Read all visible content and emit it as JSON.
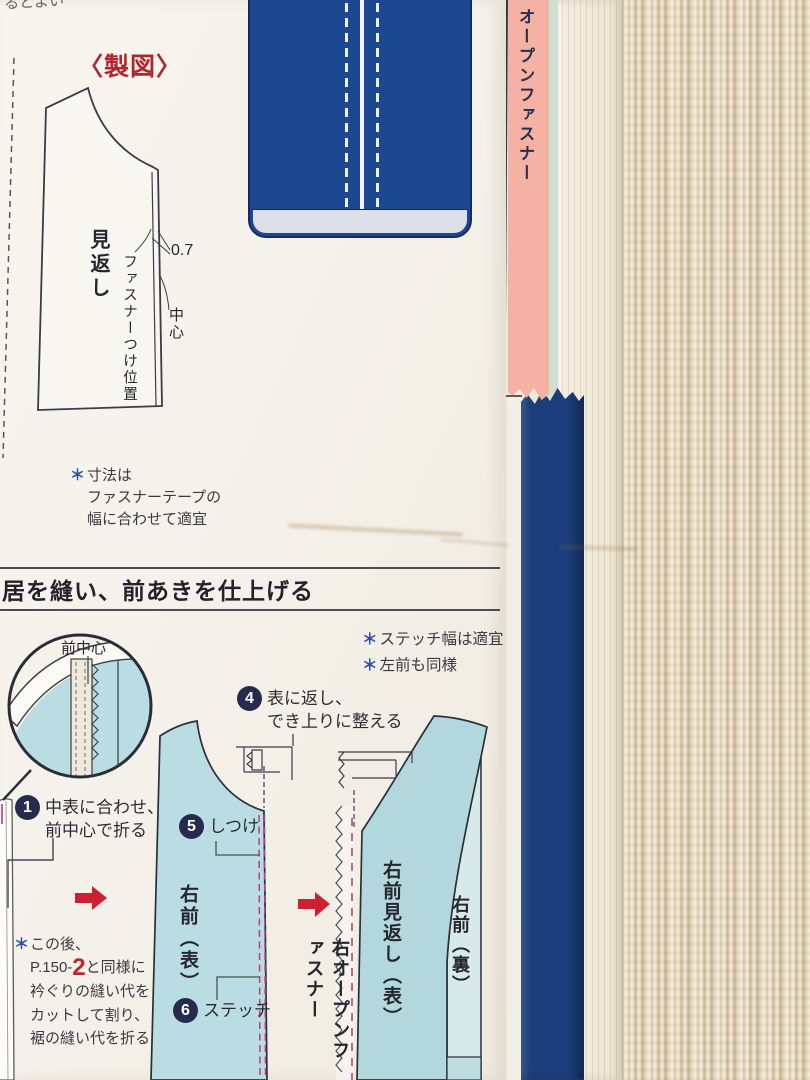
{
  "page": {
    "top_fragment": "るとよい",
    "drafting": {
      "title": "〈製図〉",
      "piece_label": "見返し",
      "zipper_position_label": "ファスナーつけ位置",
      "dimension": "0.7",
      "center_label": "中心",
      "note": {
        "star": "＊",
        "text": "寸法は\nファスナーテープの\n幅に合わせて適宜"
      }
    },
    "section_header": "居を縫い、前あきを仕上げる",
    "side_tab": "オープンファスナー",
    "steps_section": {
      "detail_label": "前中心",
      "notes": [
        {
          "star": "＊",
          "text": "ステッチ幅は適宜"
        },
        {
          "star": "＊",
          "text": "左前も同様"
        }
      ],
      "steps": [
        {
          "num": "1",
          "text": "中表に合わせ、\n前中心で折る"
        },
        {
          "num": "4",
          "text": "表に返し、\nでき上りに整える"
        },
        {
          "num": "5",
          "text": "しつけ"
        },
        {
          "num": "6",
          "text": "ステッチ"
        }
      ],
      "labels": {
        "right_front_outside": "右前（表）",
        "right_open_fastener": "右オープンファスナー",
        "right_front_facing": "右前見返し（表）",
        "right_front_inside": "右前（裏）"
      },
      "footnote": {
        "star": "＊",
        "line1": "この後、",
        "line2_pre": "P.150-",
        "page_ref": "2",
        "line2_post": "と同様に",
        "rest": "衿ぐりの縫い代を\nカットして割り、\n裾の縫い代を折る"
      }
    },
    "colors": {
      "accent_red": "#c0272d",
      "title_red": "#b0282e",
      "asterisk_blue": "#2d4fa1",
      "number_badge_navy": "#262b4e",
      "fabric_light_blue": "#b9dde2",
      "stitch_pink": "#b5417d",
      "zipper_illustration_navy": "#1c4892",
      "bookmark_pink": "#f5b1a3",
      "cover_navy": "#1d3e7c",
      "page_cream": "#f4f1ea",
      "background_beige": "#d9c7a5"
    }
  }
}
